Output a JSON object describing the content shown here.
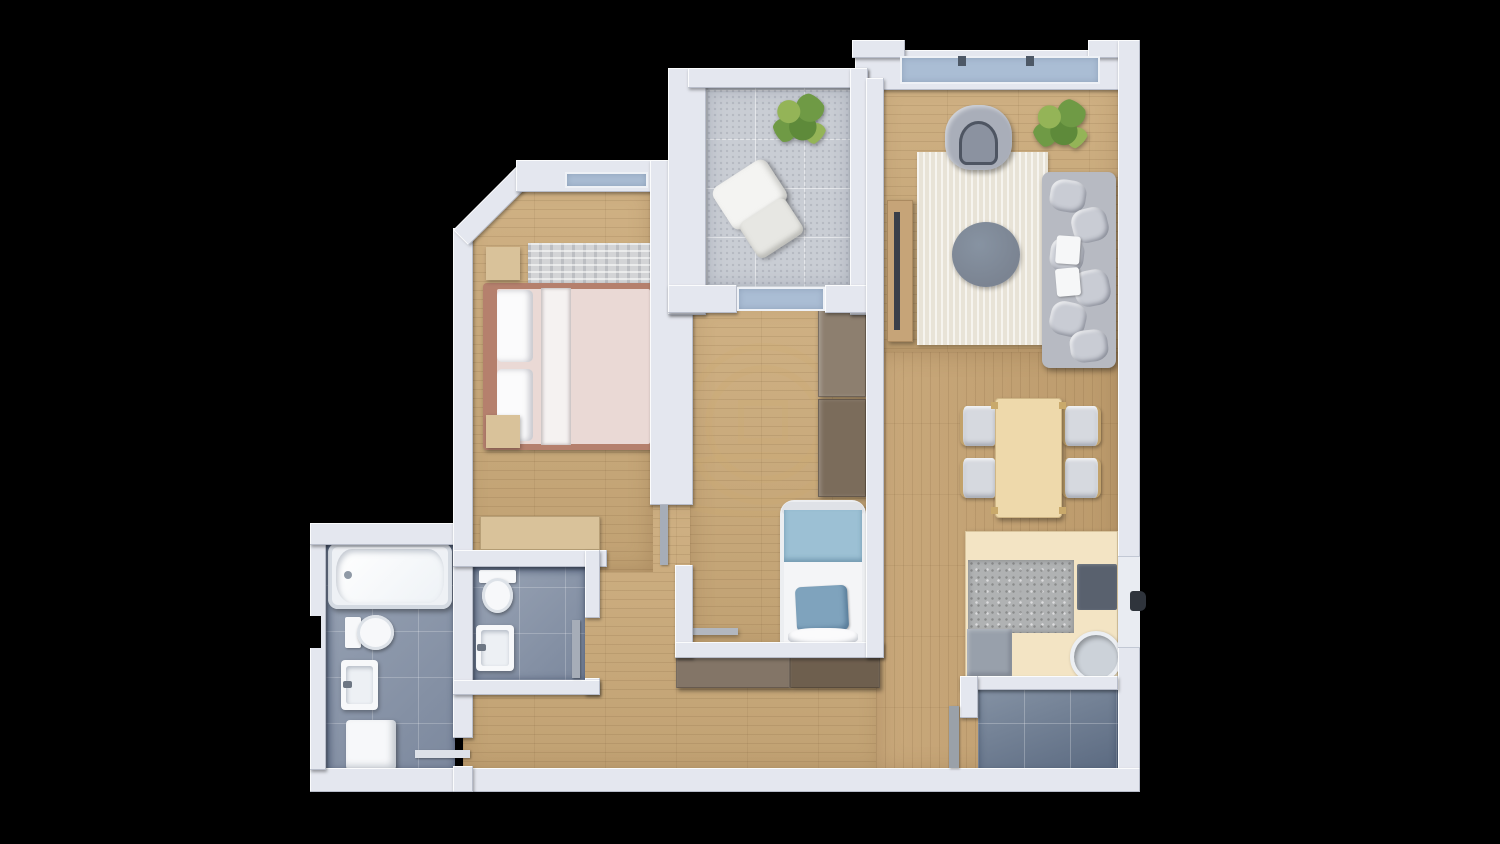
{
  "canvas": {
    "width": 1500,
    "height": 844,
    "description": "3D top-down rendered floor plan of a 2-bedroom apartment on black background, no visible text"
  },
  "palette": {
    "background": "#000000",
    "wall": "#e4e7ef",
    "wall_shade": "#c8cdd9",
    "glass": "#aabdd4",
    "wood": "#cbaa79",
    "wood_deep": "#c5a271",
    "tile_balcony": "#c9cdd4",
    "tile_bath": "#8d99ac",
    "tile_entry": "#78879b",
    "white": "#f7f8fa",
    "bed_frame": "#b5806d",
    "duvet": "#ead9d5",
    "rug_gray": "#d3d4d6",
    "rug_cream": "#e8e3d7",
    "blue_blanket": "#9cc0d4",
    "blue_pillow": "#7fa3bd",
    "sofa_gray": "#b7bac2",
    "cushion": "#c9ccd4",
    "coffee_table": "#7b8492",
    "armchair": "#a9aeb9",
    "tv_wood": "#c6a478",
    "tv_screen": "#3a3f49",
    "dresser_wood": "#d9c29a",
    "wardrobe_a": "#8d7f6f",
    "wardrobe_b": "#7b6c5b",
    "console_a": "#837567",
    "console_b": "#6e5f4e",
    "dining_wood": "#eed9ab",
    "counter": "#f3e4c4",
    "granite": "#b0b2b3",
    "stove": "#59616e",
    "appliance": "#98a0ab",
    "plant": "#6f9a45",
    "plant_light": "#94b457",
    "handle": "#2f343c",
    "leaf_gray": "#a6adb8",
    "leaf_entry": "#9aa1a9",
    "watermark": "rgba(205,170,108,0.32)"
  },
  "watermark": {
    "present": true,
    "shape": "circular logo with house glyph and ellipse, faint tan"
  },
  "rooms": [
    {
      "id": "bedroom",
      "floor": "wood",
      "furniture": [
        "double-bed",
        "two-nightstands",
        "area-rug",
        "dresser",
        "window",
        "chamfered-corner-wall"
      ]
    },
    {
      "id": "balcony",
      "floor": "stone-tile",
      "furniture": [
        "potted-plant",
        "lounge-chair",
        "glass-door"
      ]
    },
    {
      "id": "living-room",
      "floor": "wood",
      "furniture": [
        "large-window",
        "armchair",
        "potted-plant",
        "area-rug",
        "round-coffee-table",
        "sofa",
        "tv-sideboard"
      ]
    },
    {
      "id": "dining-area",
      "floor": "wood",
      "furniture": [
        "dining-table",
        "four-chairs"
      ]
    },
    {
      "id": "kitchen",
      "floor": "wood",
      "furniture": [
        "counter",
        "granite-worktop",
        "cooktop",
        "round-sink",
        "appliance"
      ]
    },
    {
      "id": "kids-room",
      "floor": "wood",
      "furniture": [
        "wardrobe",
        "single-bed",
        "wall-shelf",
        "balcony-door"
      ]
    },
    {
      "id": "bathroom",
      "floor": "blue-tile",
      "furniture": [
        "bathtub",
        "toilet",
        "washbasin",
        "washing-machine",
        "door"
      ]
    },
    {
      "id": "wc",
      "floor": "blue-tile",
      "furniture": [
        "toilet",
        "washbasin",
        "door"
      ]
    },
    {
      "id": "hallway",
      "floor": "wood",
      "furniture": [
        "console-cabinet",
        "entrance-door-leaf",
        "door-handle"
      ]
    },
    {
      "id": "entrance",
      "floor": "gray-tile",
      "furniture": []
    }
  ]
}
